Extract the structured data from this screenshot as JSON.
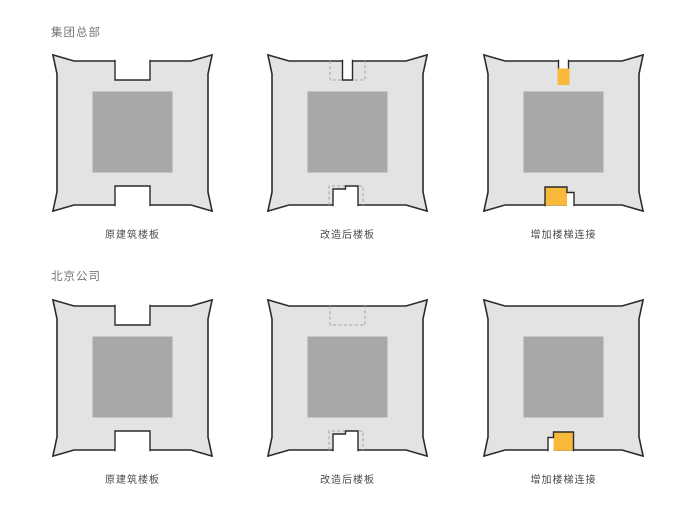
{
  "colors": {
    "background": "#ffffff",
    "slab": "#e3e3e4",
    "core": "#a8a8a9",
    "outline": "#2b2b2b",
    "dashed_line": "#a0a0a0",
    "stair_highlight": "#f8b83a",
    "header_text": "#757575",
    "label_text": "#4a4a4a"
  },
  "sections": [
    {
      "header": "集团总部",
      "plans": [
        {
          "label": "原建筑楼板",
          "top": "wide",
          "bottom": "wide"
        },
        {
          "label": "改造后楼板",
          "top": "narrow-dashed",
          "bottom": "open-dashed"
        },
        {
          "label": "增加楼梯连接",
          "top": "stair",
          "bottom": "stair-gap-right"
        }
      ]
    },
    {
      "header": "北京公司",
      "plans": [
        {
          "label": "原建筑楼板",
          "top": "wide",
          "bottom": "wide"
        },
        {
          "label": "改造后楼板",
          "top": "dashed",
          "bottom": "open-dashed"
        },
        {
          "label": "增加楼梯连接",
          "top": "solid",
          "bottom": "stair-gap-left"
        }
      ]
    }
  ]
}
